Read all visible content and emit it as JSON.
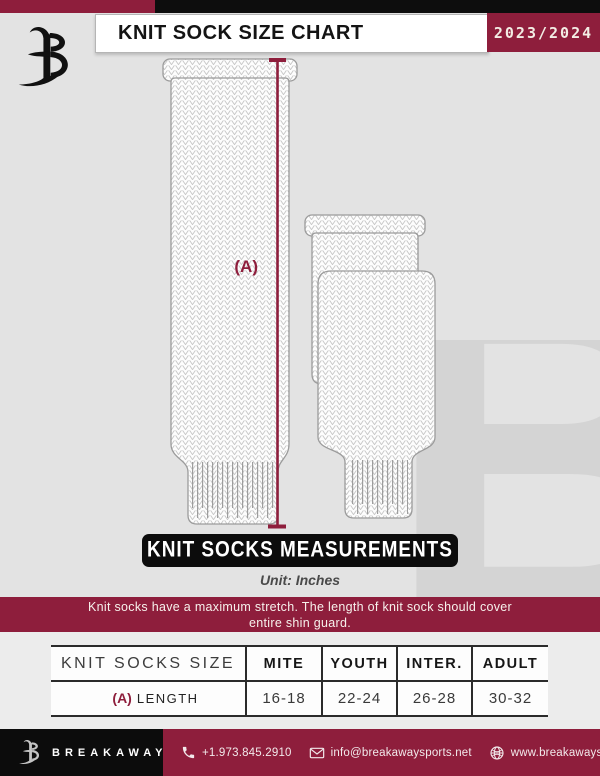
{
  "header": {
    "title": "KNIT SOCK SIZE CHART",
    "season": "2023/2024"
  },
  "diagram": {
    "measure_label": "(A)"
  },
  "measurements": {
    "banner": "KNIT SOCKS MEASUREMENTS",
    "unit": "Unit: Inches"
  },
  "note": {
    "line1": "Knit socks have a maximum stretch. The length of knit sock should cover",
    "line2": "entire shin guard."
  },
  "size_table": {
    "columns": [
      "KNIT SOCKS SIZE",
      "MITE",
      "YOUTH",
      "INTER.",
      "ADULT"
    ],
    "rows": [
      {
        "label_key": "(A)",
        "label": "LENGTH",
        "values": [
          "16-18",
          "22-24",
          "26-28",
          "30-32"
        ]
      }
    ]
  },
  "footer": {
    "brand": "BREAKAWAY",
    "phone": "+1.973.845.2910",
    "email": "info@breakawaysports.net",
    "website": "www.breakawaysports.net"
  },
  "colors": {
    "maroon": "#8e1e3c",
    "black": "#0d0d0d",
    "page_bg": "#e3e3e3"
  }
}
